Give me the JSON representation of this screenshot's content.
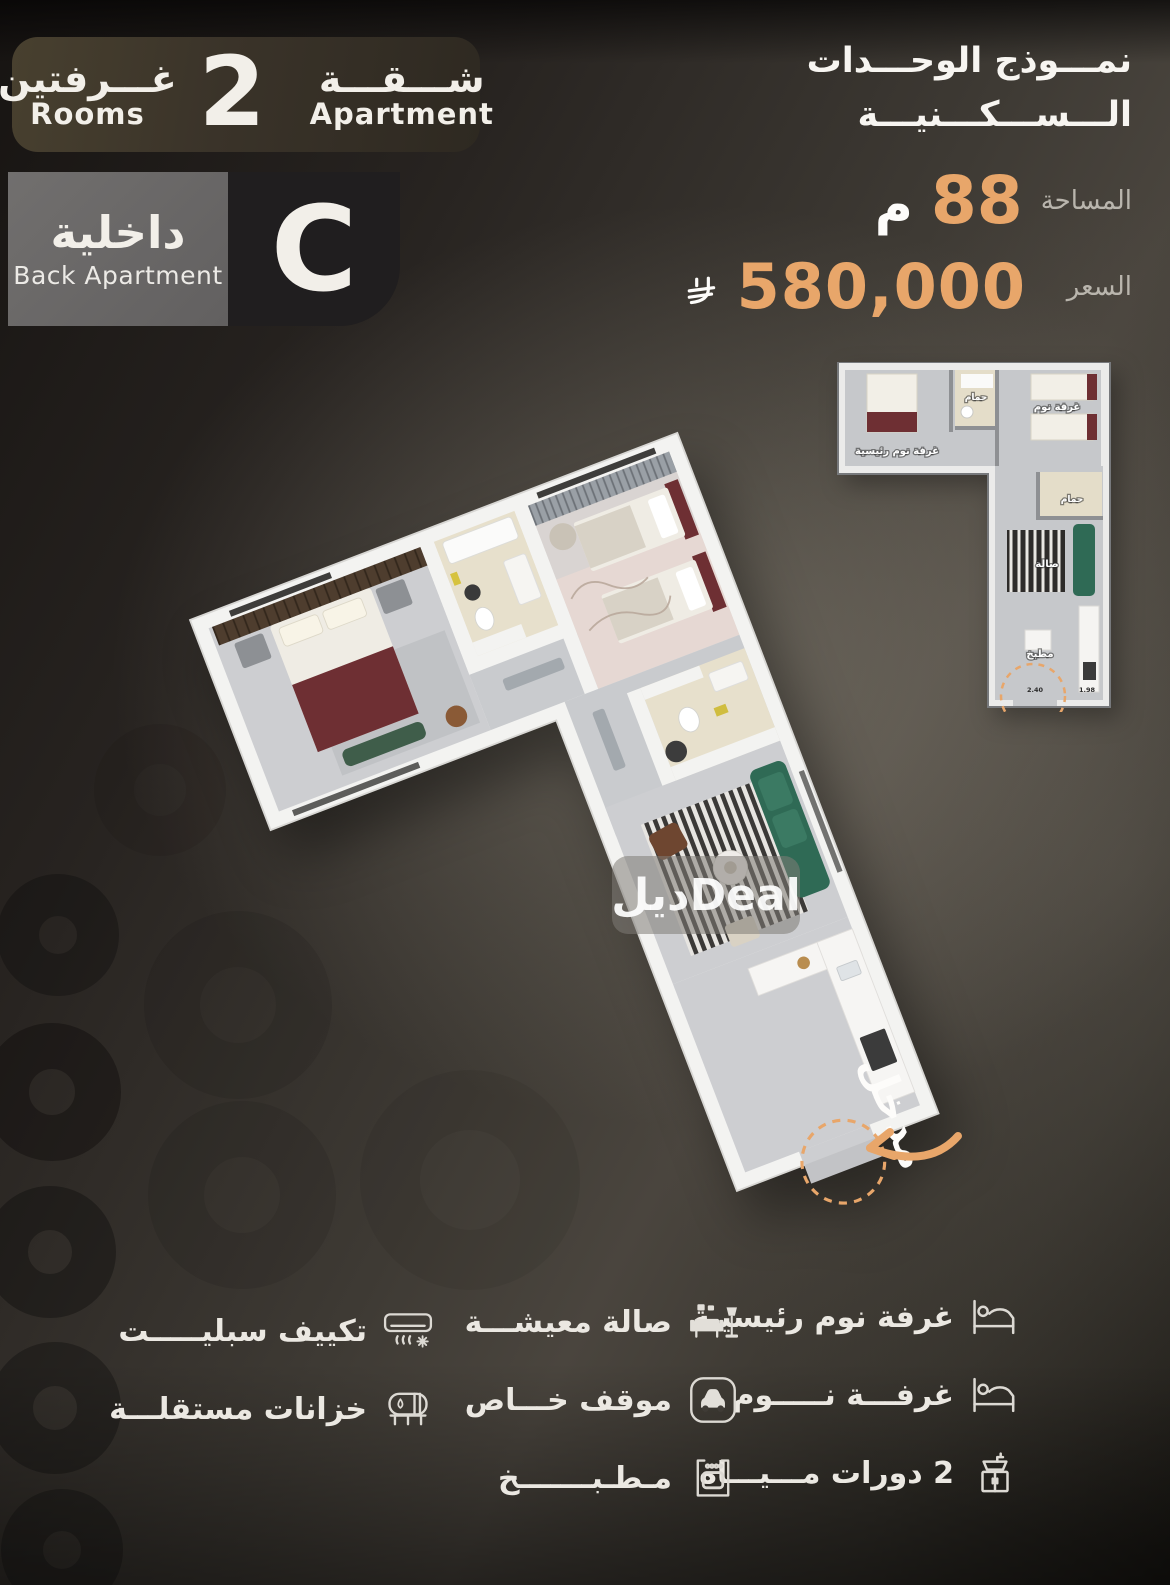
{
  "header": {
    "title_line1": "نمـــوذج الوحـــدات",
    "title_line2": "الـــســـكـــنيـــة"
  },
  "badge": {
    "rooms_ar": "غـــرفتين",
    "rooms_en": "Rooms",
    "count": "2",
    "apartment_ar": "شـــقـــة",
    "apartment_en": "Apartment"
  },
  "unit": {
    "type_ar": "داخلية",
    "type_en": "Back Apartment",
    "letter": "C"
  },
  "specs": {
    "area_label": "المساحة",
    "area_value": "88",
    "area_unit": "م",
    "price_label": "السعر",
    "price_value": "580,000",
    "currency_icon": "saudi-riyal-symbol"
  },
  "plan": {
    "watermark": "ديلDeal",
    "entrance_label": "مدخل"
  },
  "mini_plan": {
    "master_bedroom": "غرفة نوم رئيسية",
    "bath1": "حمام",
    "bedroom": "غرفة نوم",
    "bath2": "حمام",
    "living": "صالة",
    "kitchen": "مطبخ",
    "dim1": "2.40",
    "dim2": "1.98"
  },
  "features": {
    "col_right": [
      {
        "icon": "bed-icon",
        "label": "غرفة نوم رئيسيـة"
      },
      {
        "icon": "bed-icon",
        "label": "غرفـــة نـــــوم"
      },
      {
        "icon": "sink-icon",
        "label": "2 دورات مـــيـــاه"
      }
    ],
    "col_middle": [
      {
        "icon": "living-room-icon",
        "label": "صالة معيشـــة"
      },
      {
        "icon": "car-icon",
        "label": "موقف خـــاص"
      },
      {
        "icon": "oven-icon",
        "label": "مـطـبـــــــخ"
      }
    ],
    "col_left": [
      {
        "icon": "ac-split-icon",
        "label": "تكييف سبليـــــت"
      },
      {
        "icon": "water-tank-icon",
        "label": "خزانات مستقلـــة"
      }
    ]
  },
  "colors": {
    "accent_orange": "#e8a66a",
    "text_light": "#f2efe9",
    "text_muted": "#b9b5ad",
    "maroon_bed": "#6e2f33",
    "green_sofa": "#2f6a55"
  }
}
